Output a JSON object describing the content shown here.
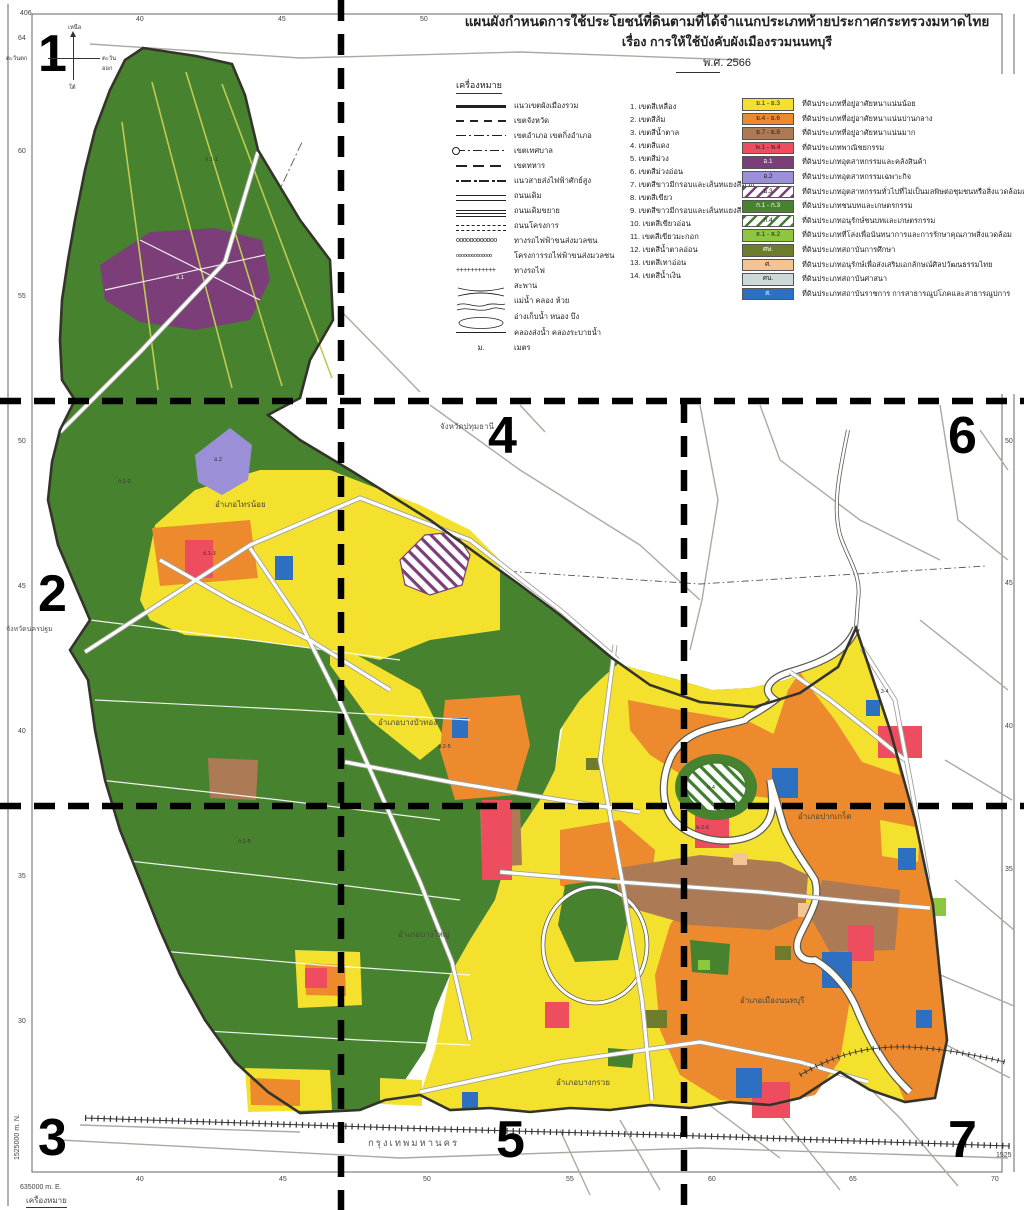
{
  "palette": {
    "yellow": "#f3e12e",
    "orange": "#ec8a2d",
    "brown": "#ad7a56",
    "red": "#ee4d60",
    "purple": "#7b3e78",
    "lightpurple": "#9b90d8",
    "green": "#47822f",
    "brightgreen": "#8dc63f",
    "olive": "#6d7b2c",
    "tan": "#f4c492",
    "lightgray": "#ccd8da",
    "blue": "#2d6fc0",
    "boundary": "#35342b",
    "roadcasing": "#a2a29a",
    "water": "#ffffff",
    "watercasing": "#5b5b50",
    "dashline": "#000000",
    "canal": "#c0ca52"
  },
  "title": {
    "line1": "แผนผังกำหนดการใช้ประโยชน์ที่ดินตามที่ได้จำแนกประเภทท้ายประกาศกระทรวงมหาดไทย",
    "line2": "เรื่อง การให้ใช้บังคับผังเมืองรวมนนทบุรี",
    "line3": "พ.ศ. 2566"
  },
  "legend": {
    "header": "เครื่องหมาย",
    "lines": [
      {
        "symbol": "thick-line",
        "label": "แนวเขตผังเมืองรวม"
      },
      {
        "symbol": "dashed-line",
        "label": "เขตจังหวัด"
      },
      {
        "symbol": "dash-dot-line",
        "label": "เขตอำเภอ เขตกิ่งอำเภอ"
      },
      {
        "symbol": "circle-dash-dot-line",
        "label": "เขตเทศบาล"
      },
      {
        "symbol": "long-dash-line",
        "label": "เขตทหาร"
      },
      {
        "symbol": "dot-dash-line",
        "label": "แนวสายส่งไฟฟ้าศักย์สูง"
      },
      {
        "symbol": "double-line",
        "label": "ถนนเดิม"
      },
      {
        "symbol": "double-line-wide",
        "label": "ถนนเดิมขยาย"
      },
      {
        "symbol": "double-dashed-line",
        "label": "ถนนโครงการ"
      },
      {
        "symbol": "circles-line",
        "label": "ทางรถไฟฟ้าขนส่งมวลชน"
      },
      {
        "symbol": "small-circles-line",
        "label": "โครงการรถไฟฟ้าขนส่งมวลชน"
      },
      {
        "symbol": "cross-line",
        "label": "ทางรถไฟ"
      },
      {
        "symbol": "bridge",
        "label": "สะพาน"
      },
      {
        "symbol": "wavy-lines",
        "label": "แม่น้ำ คลอง ห้วย"
      },
      {
        "symbol": "pond-outline",
        "label": "อ่างเก็บน้ำ หนอง บึง"
      },
      {
        "symbol": "thin-line",
        "label": "คลองส่งน้ำ คลองระบายน้ำ"
      },
      {
        "symbol": "m-abbr",
        "label": "เมตร",
        "abbr": "ม."
      }
    ],
    "zones": [
      "1. เขตสีเหลือง",
      "2. เขตสีส้ม",
      "3. เขตสีน้ำตาล",
      "4. เขตสีแดง",
      "5. เขตสีม่วง",
      "6. เขตสีม่วงอ่อน",
      "7. เขตสีขาวมีกรอบและเส้นทแยงสีม่วง",
      "8. เขตสีเขียว",
      "9. เขตสีขาวมีกรอบและเส้นทแยงสีเขียว",
      "10. เขตสีเขียวอ่อน",
      "11. เขตสีเขียวมะกอก",
      "12. เขตสีน้ำตาลอ่อน",
      "13. เขตสีเทาอ่อน",
      "14. เขตสีน้ำเงิน"
    ],
    "categories": [
      {
        "code": "ย.1 - ย.3",
        "color": "yellow",
        "label": "ที่ดินประเภทที่อยู่อาศัยหนาแน่นน้อย"
      },
      {
        "code": "ย.4 - ย.6",
        "color": "orange",
        "label": "ที่ดินประเภทที่อยู่อาศัยหนาแน่นปานกลาง"
      },
      {
        "code": "ย.7 - ย.8",
        "color": "brown",
        "label": "ที่ดินประเภทที่อยู่อาศัยหนาแน่นมาก"
      },
      {
        "code": "พ.1 - พ.4",
        "color": "red",
        "label": "ที่ดินประเภทพาณิชยกรรม"
      },
      {
        "code": "อ.1",
        "color": "purple",
        "label": "ที่ดินประเภทอุตสาหกรรมและคลังสินค้า"
      },
      {
        "code": "อ.2",
        "color": "lightpurple",
        "label": "ที่ดินประเภทอุตสาหกรรมเฉพาะกิจ"
      },
      {
        "code": "อ.3",
        "color": "hatch-purple",
        "label": "ที่ดินประเภทอุตสาหกรรมทั่วไปที่ไม่เป็นมลพิษต่อชุมชนหรือสิ่งแวดล้อมและคลังสินค้า"
      },
      {
        "code": "ก.1 - ก.3",
        "color": "green",
        "label": "ที่ดินประเภทชนบทและเกษตรกรรม"
      },
      {
        "code": "ก.4",
        "color": "hatch-green",
        "label": "ที่ดินประเภทอนุรักษ์ชนบทและเกษตรกรรม"
      },
      {
        "code": "ล.1 - ล.2",
        "color": "brightgreen",
        "label": "ที่ดินประเภทที่โล่งเพื่อนันทนาการและการรักษาคุณภาพสิ่งแวดล้อม"
      },
      {
        "code": "ศษ.",
        "color": "olive",
        "label": "ที่ดินประเภทสถาบันการศึกษา"
      },
      {
        "code": "ศ.",
        "color": "tan",
        "label": "ที่ดินประเภทอนุรักษ์เพื่อส่งเสริมเอกลักษณ์ศิลปวัฒนธรรมไทย"
      },
      {
        "code": "ศน.",
        "color": "lightgray",
        "label": "ที่ดินประเภทสถาบันศาสนา"
      },
      {
        "code": "ส.",
        "color": "blue",
        "label": "ที่ดินประเภทสถาบันราชการ การสาธารณูปโภคและสาธารณูปการ"
      }
    ]
  },
  "sections": [
    "1",
    "2",
    "3",
    "4",
    "5",
    "6",
    "7"
  ],
  "compass": {
    "north": "เหนือ",
    "south": "ใต้",
    "west": "ตะวันตก",
    "east": "ตะวันออก"
  },
  "map_labels": {
    "province_top": "จังหวัดปทุมธานี",
    "province_left": "จังหวัดนครปฐม",
    "bangkok": "กรุงเทพมหานคร",
    "districts": [
      {
        "label": "อำเภอไทรน้อย"
      },
      {
        "label": "อำเภอบางบัวทอง"
      },
      {
        "label": "อำเภอบางใหญ่"
      },
      {
        "label": "อำเภอปากเกร็ด"
      },
      {
        "label": "อำเภอเมืองนนทบุรี"
      },
      {
        "label": "อำเภอบางกรวย"
      }
    ],
    "codes": [
      {
        "label": "ก.1-1"
      },
      {
        "label": "ก.1-2"
      },
      {
        "label": "ก.1-5"
      },
      {
        "label": "ย.1-3"
      },
      {
        "label": "อ.1"
      },
      {
        "label": "อ.2"
      },
      {
        "label": "ย.2-5"
      },
      {
        "label": "พ.2-6"
      },
      {
        "label": "ก.4"
      },
      {
        "label": "ย.3-4"
      }
    ]
  },
  "frame": {
    "corner": "406",
    "top": [
      "40",
      "45",
      "50"
    ],
    "left": [
      "64",
      "60",
      "55",
      "50",
      "45",
      "40",
      "35",
      "30"
    ],
    "right": [
      "50",
      "45",
      "40",
      "35"
    ],
    "right_grid": "1525",
    "bottom": [
      "40",
      "45",
      "50",
      "55",
      "60",
      "65",
      "70"
    ],
    "bottom_left_e": "635000 m. E.",
    "left_n": "1525000 m. N.",
    "footer": "เครื่องหมาย"
  }
}
